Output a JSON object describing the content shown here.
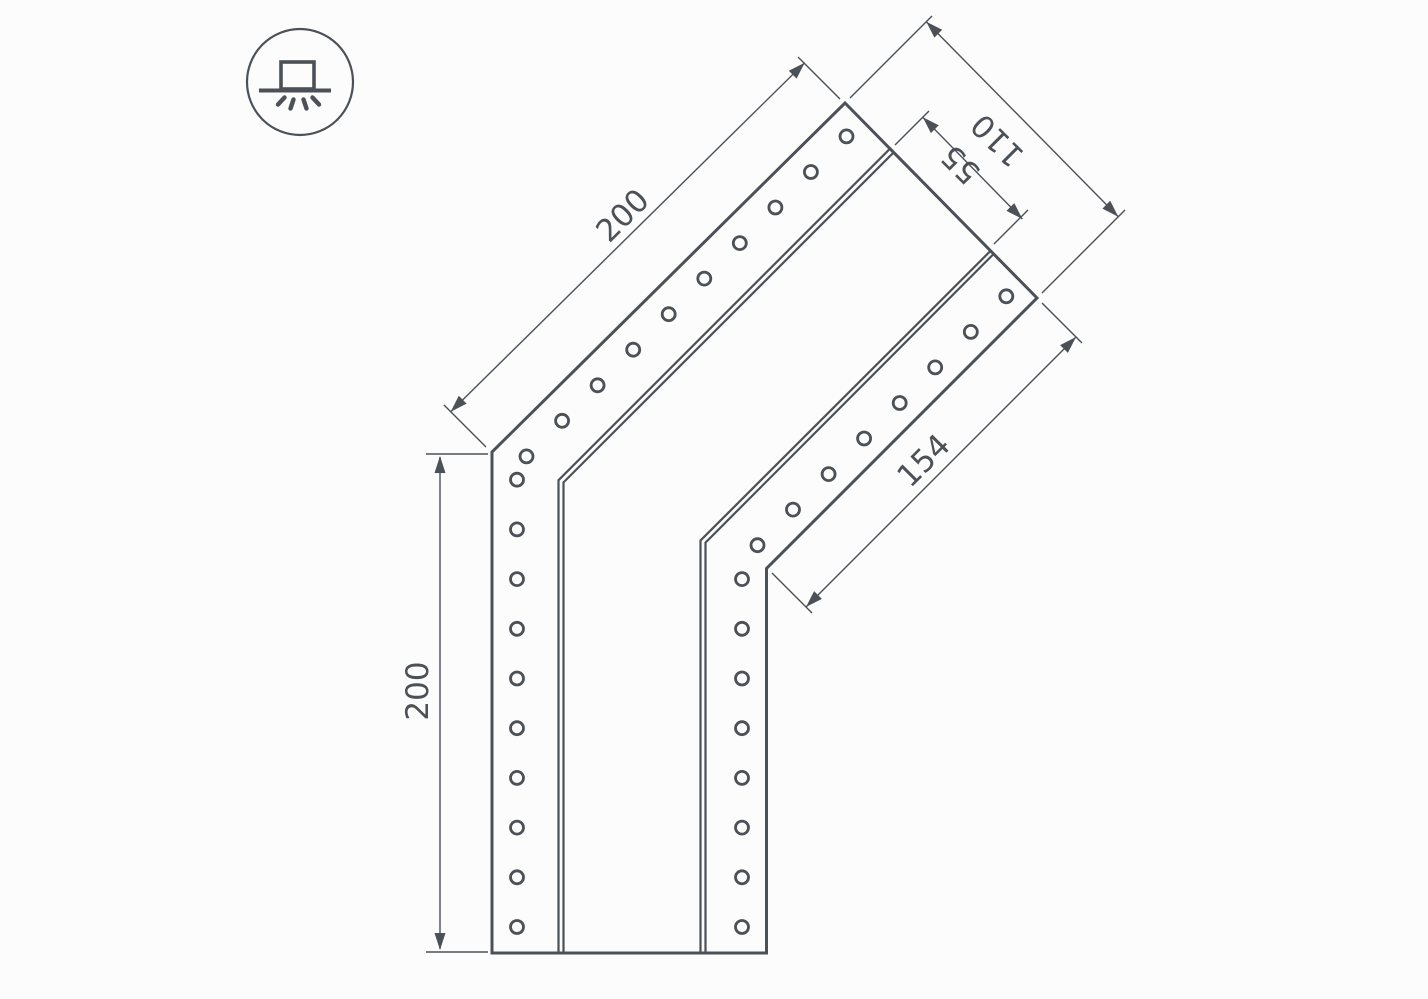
{
  "drawing": {
    "type": "technical-dimension-drawing",
    "subject": "angled-led-profile-connector-top-view",
    "background_color": "#fcfcfc",
    "line_color": "#4b5157",
    "icon": {
      "name": "surface-mounted-light-icon",
      "description": "circle badge with surface-mounted luminaire glyph and light rays"
    },
    "dimensions": {
      "outer_diagonal_length": "200",
      "end_width": "110",
      "slot_width": "55",
      "inner_diagonal_length": "154",
      "vertical_length": "200"
    }
  }
}
